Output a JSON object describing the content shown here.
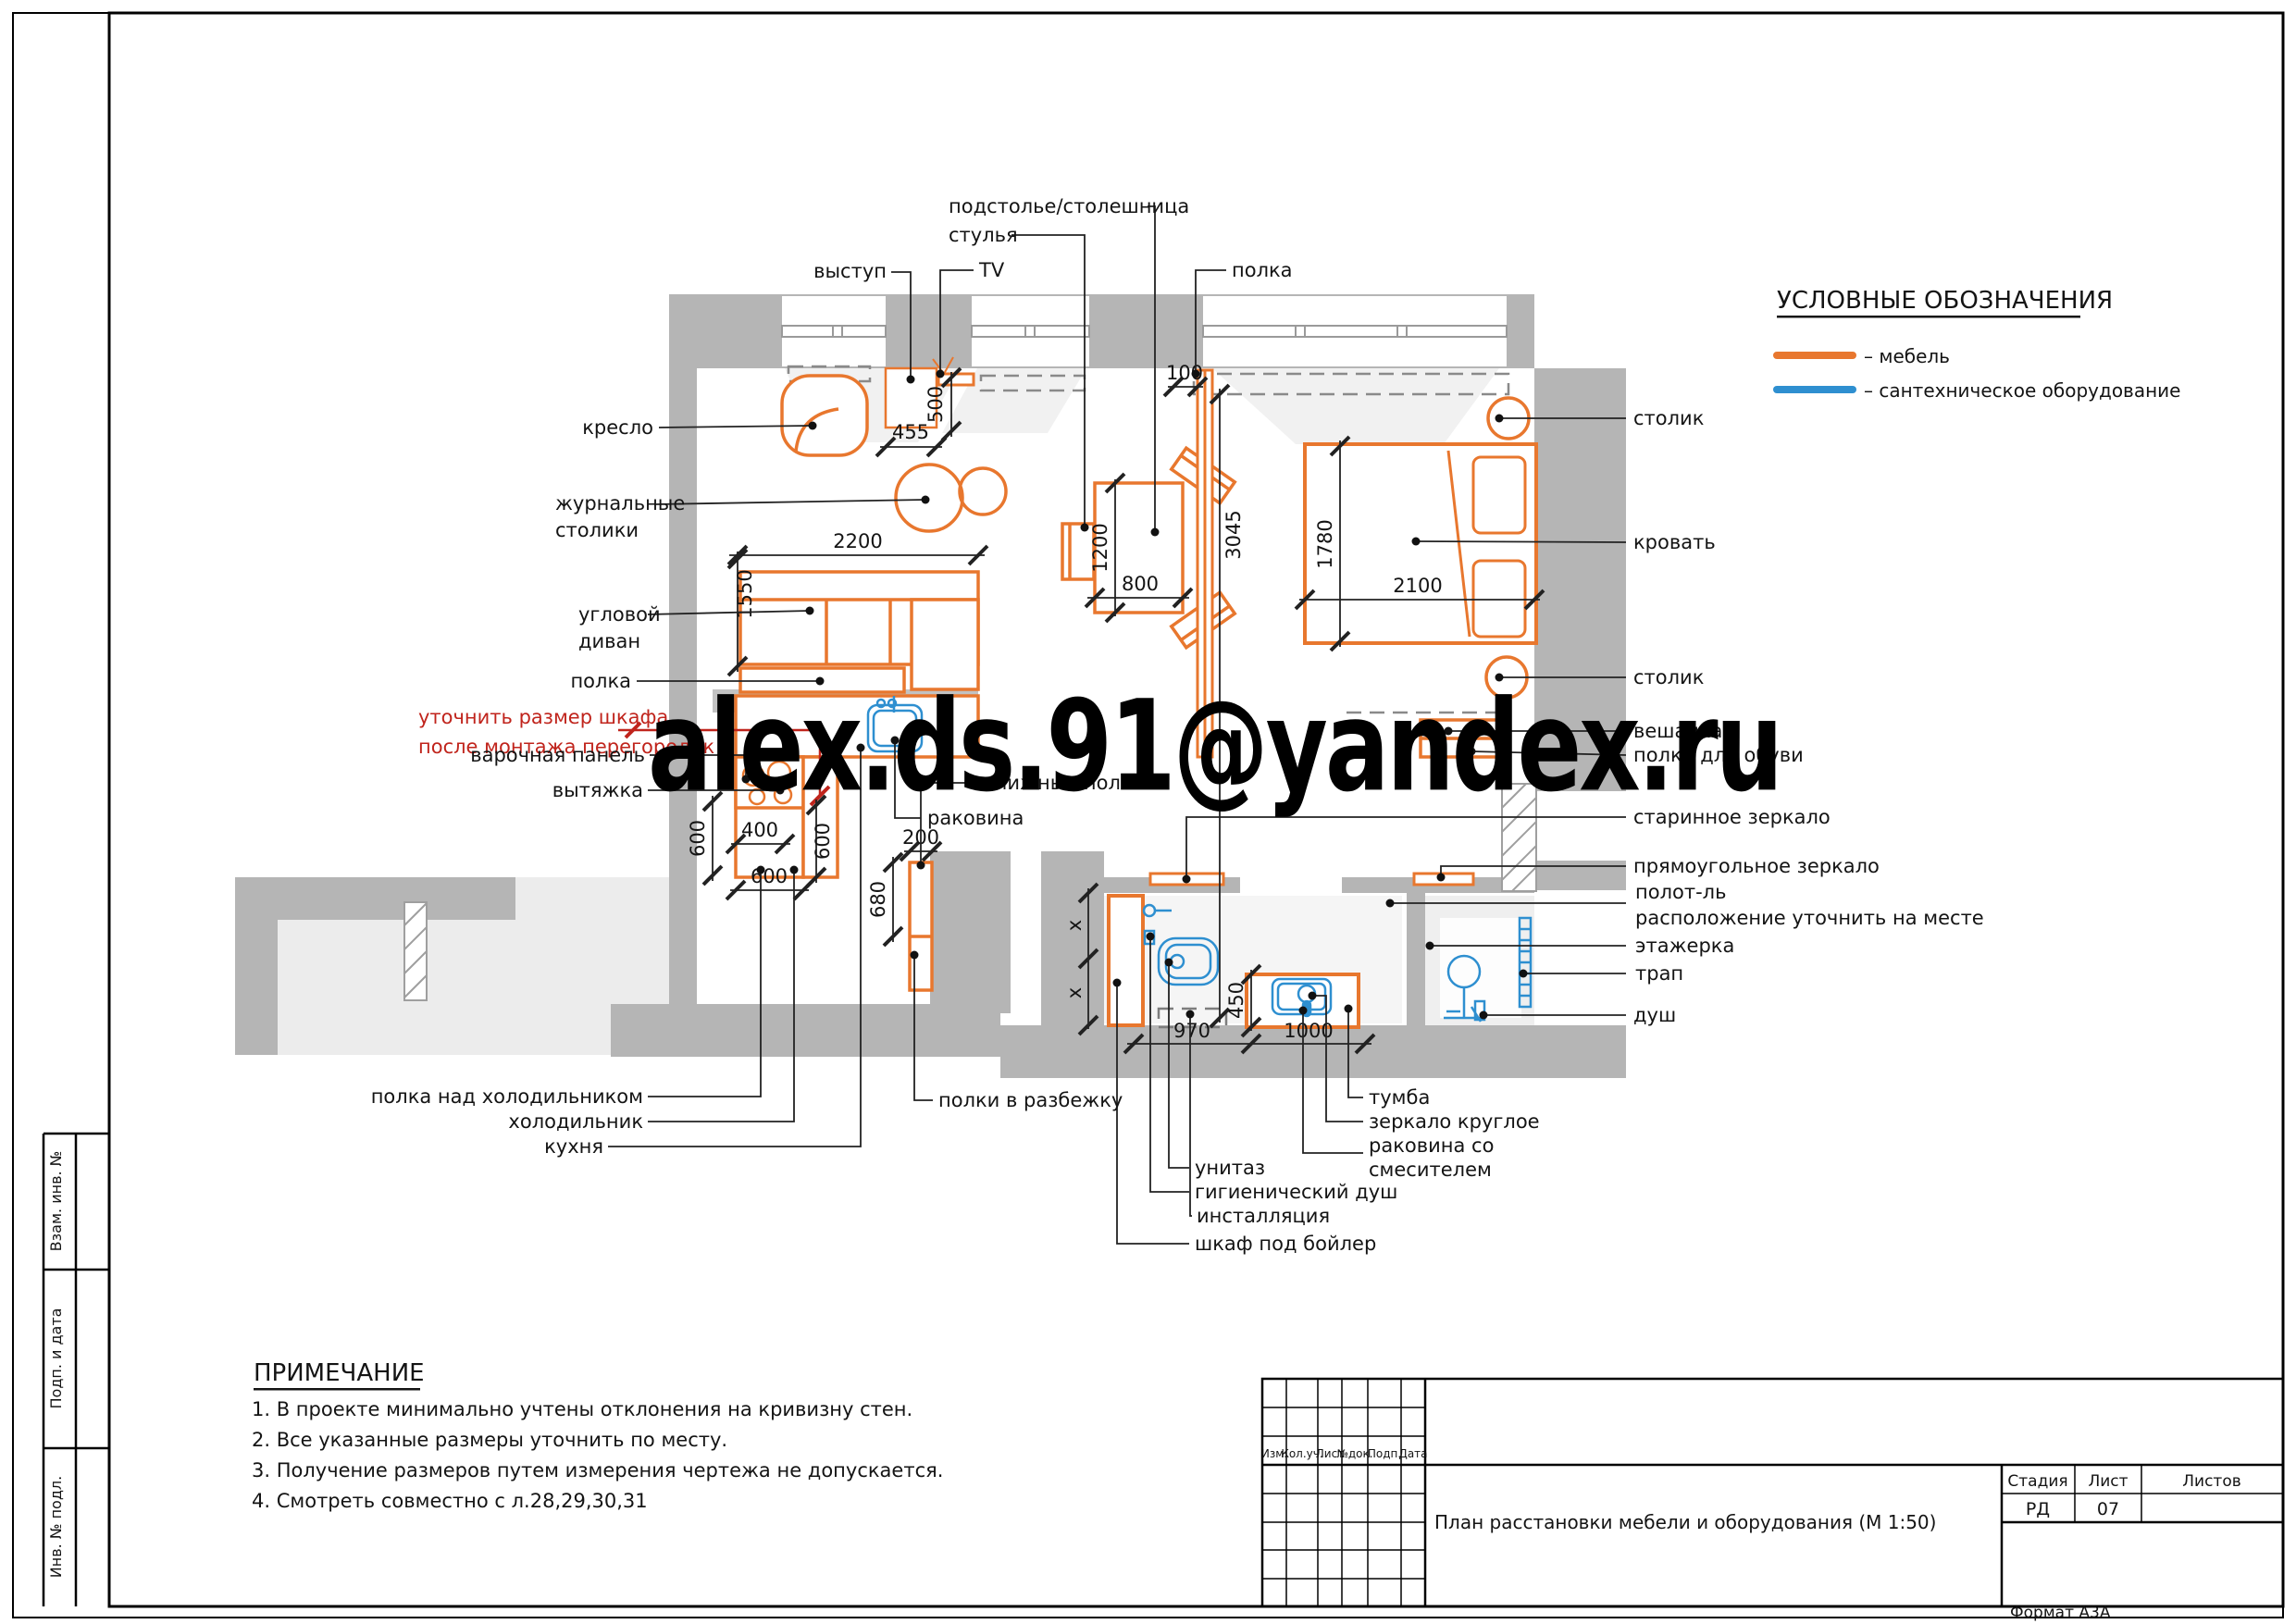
{
  "page": {
    "watermark": "alex.ds.91@yandex.ru",
    "format_note": "Формат А3А"
  },
  "colors": {
    "furniture": "#e8772e",
    "sanitary": "#2e8fd0",
    "wall": "#b5b5b5",
    "red": "#c0241c"
  },
  "legend": {
    "title": "УСЛОВНЫЕ ОБОЗНАЧЕНИЯ",
    "furniture": "– мебель",
    "sanitary": "– сантехническое оборудование"
  },
  "notes": {
    "title": "ПРИМЕЧАНИЕ",
    "items": [
      "1. В проекте минимально учтены отклонения на кривизну стен.",
      "2. Все указанные размеры уточнить по месту.",
      "3. Получение размеров путем измерения чертежа не допускается.",
      "4. Смотреть совместно с л.28,29,30,31"
    ]
  },
  "sidebar": {
    "cells": [
      "Взам. инв. №",
      "Подп. и дата",
      "Инв. № подл."
    ]
  },
  "titleblock": {
    "cols": [
      "Изм.",
      "Кол.уч.",
      "Лист",
      "№док.",
      "Подп.",
      "Дата"
    ],
    "title": "План расстановки мебели и оборудования (М 1:50)",
    "stage_label": "Стадия",
    "sheet_label": "Лист",
    "sheets_label": "Листов",
    "stage": "РД",
    "sheet": "07",
    "sheets": ""
  },
  "labels": {
    "podstolye": "подстолье/столешница",
    "stulya": "стулья",
    "vystup": "выступ",
    "tv": "TV",
    "polka_top": "полка",
    "kreslo": "кресло",
    "zhurnalnye_line1": "журнальные",
    "zhurnalnye_line2": "столики",
    "uglovoy_line1": "угловой",
    "uglovoy_line2": "диван",
    "polka_sofa": "полка",
    "red_line1": "уточнить размер шкафа",
    "red_line2": "после монтажа перегородок",
    "varochnaya": "варочная панель",
    "vytyazhka": "вытяжка",
    "rakovina": "раковина",
    "knizhnye": "книжные полки",
    "stolik_top": "столик",
    "krovat": "кровать",
    "stolik_bottom": "столик",
    "veshalka": "вешалка",
    "polka_obuvi": "полка для обуви",
    "starinnoe": "старинное зеркало",
    "pryamougolnoe": "прямоугольное зеркало",
    "polotl_line1": "полот-ль",
    "polotl_line2": "расположение уточнить на месте",
    "etazherka": "этажерка",
    "trap": "трап",
    "dush": "душ",
    "polka_holod": "полка над холодильником",
    "holodilnik": "холодильник",
    "kuhnya": "кухня",
    "polki_razbezhku": "полки в разбежку",
    "tumba": "тумба",
    "zerkalo_krugloe": "зеркало круглое",
    "rakovina_smesitel_line1": "раковина со",
    "rakovina_smesitel_line2": "смесителем",
    "unitaz": "унитаз",
    "gig_dush": "гигиенический душ",
    "installyatsiya": "инсталляция",
    "shkaf_boyler": "шкаф под бойлер"
  },
  "dims": {
    "d455": "455",
    "d500": "500",
    "d100": "100",
    "d3045": "3045",
    "d1200": "1200",
    "d800": "800",
    "d2200": "2200",
    "d1550": "1550",
    "d1780": "1780",
    "d2100": "2100",
    "d600_left": "600",
    "d400": "400",
    "d600_right": "600",
    "d600_bottom": "600",
    "d200": "200",
    "d680": "680",
    "dx_upper": "x",
    "dx_lower": "x",
    "d450": "450",
    "d970": "970",
    "d1000": "1000"
  }
}
